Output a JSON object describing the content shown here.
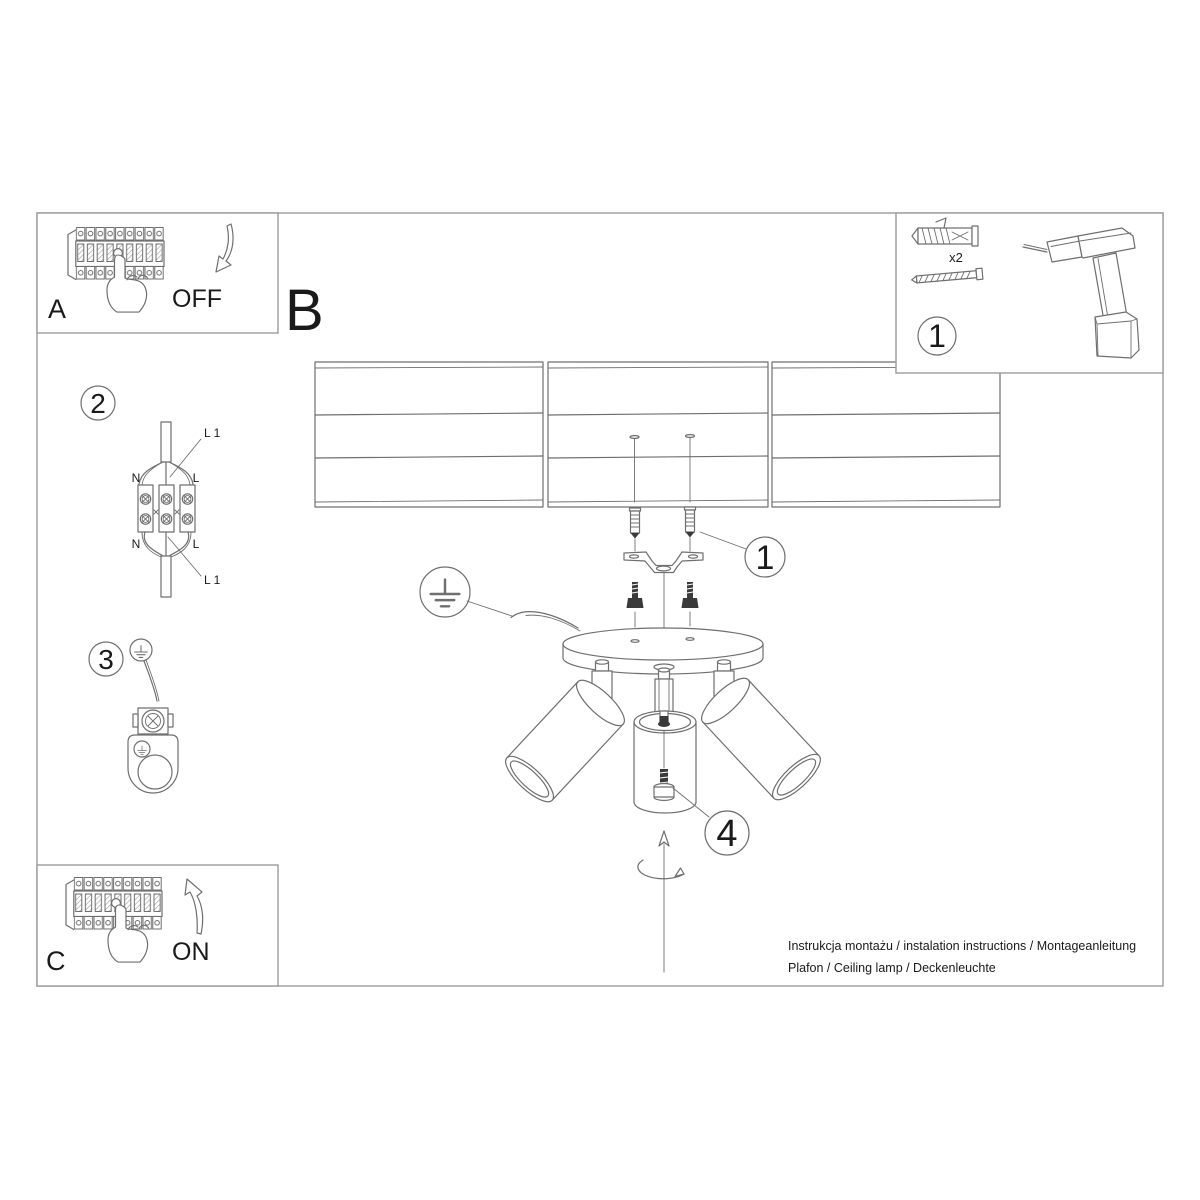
{
  "doc": {
    "footer_line1": "Instrukcja montażu / instalation instructions / Montageanleitung",
    "footer_line2": "Plafon / Ceiling lamp / Deckenleuchte"
  },
  "sections": {
    "power_off": {
      "label": "A",
      "state": "OFF"
    },
    "mounting": {
      "label": "B"
    },
    "power_on": {
      "label": "C",
      "state": "ON"
    }
  },
  "steps": {
    "kit": {
      "number": "1",
      "anchor_qty": "x2"
    },
    "wiring": {
      "number": "2",
      "labels": {
        "top_line": "L 1",
        "top_neutral": "N",
        "top_live": "L",
        "bottom_neutral": "N",
        "bottom_live": "L",
        "bottom_line": "L 1"
      }
    },
    "grounding": {
      "number": "3"
    },
    "fixing": {
      "number": "1"
    },
    "adjust": {
      "number": "4"
    }
  },
  "colors": {
    "line": "#6f6f6f",
    "frame": "#9b9b9b",
    "text": "#1a1a1a",
    "dark_fill": "#3a3a3a",
    "background": "#ffffff"
  }
}
